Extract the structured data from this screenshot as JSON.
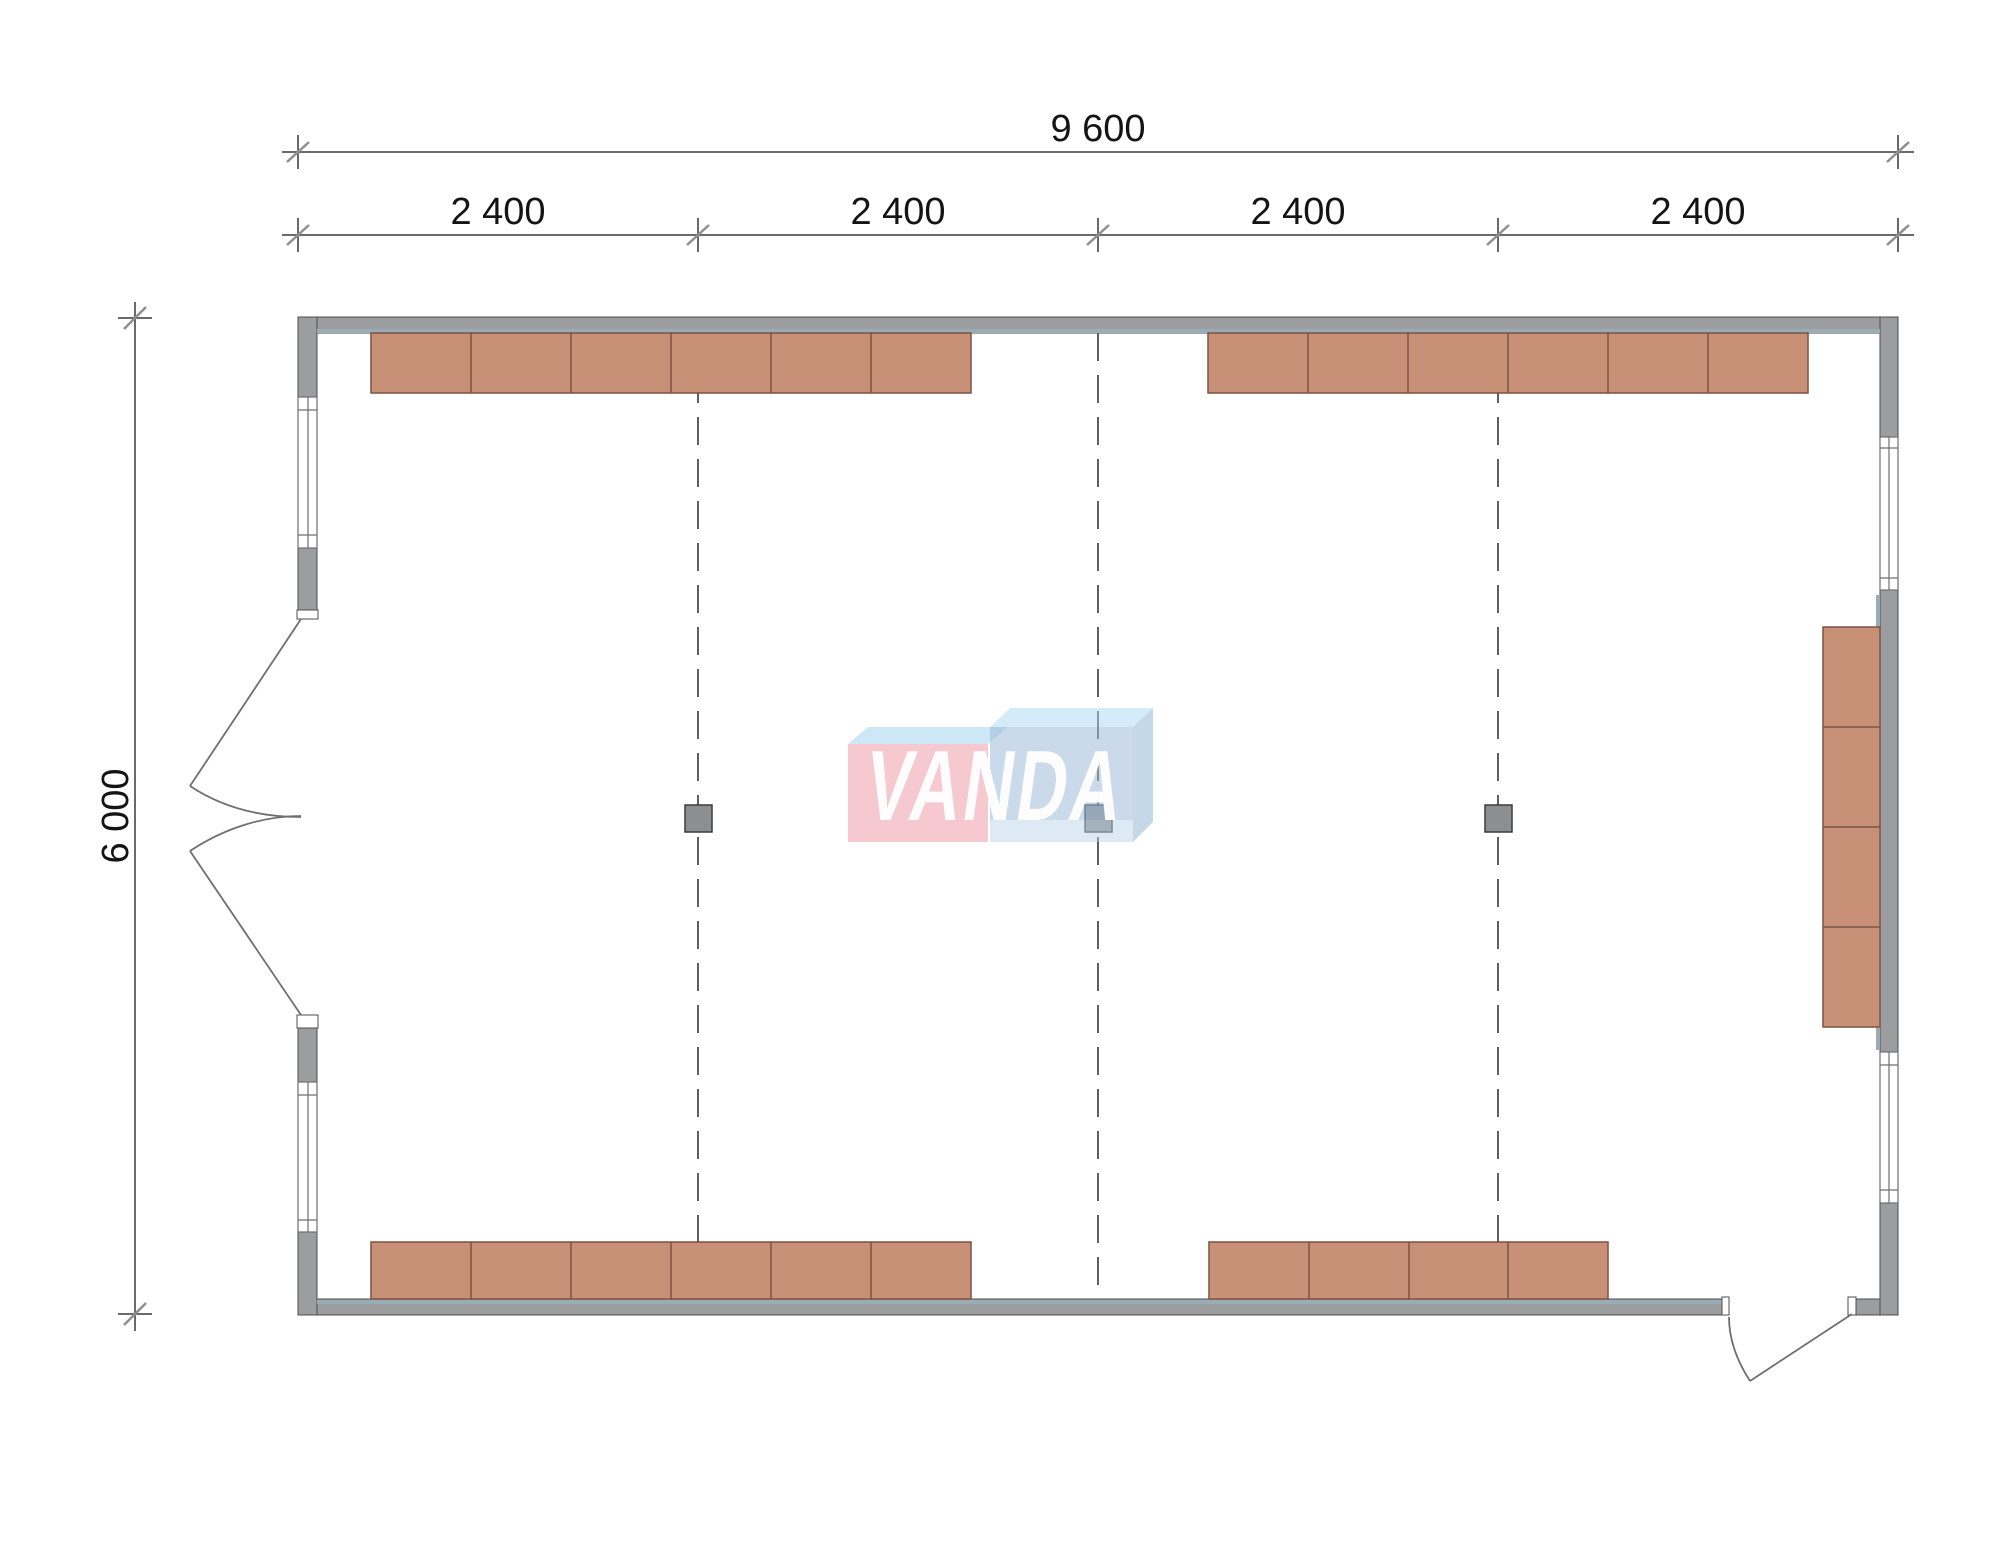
{
  "drawing": {
    "dimensions": {
      "total_width": "9 600",
      "segments": [
        "2 400",
        "2 400",
        "2 400",
        "2 400"
      ],
      "height": "6 000"
    },
    "watermark": "VANDA"
  },
  "colors": {
    "wall": "#9b9d9e",
    "wall_outline": "#4d4d4d",
    "lining": "#9aacb6",
    "furniture": "#c79077",
    "furniture_outline": "#7a5340",
    "dim_line": "#6a6a6a",
    "dim_slash": "#8f8f8f",
    "dim_text": "#141414",
    "win_line": "#6f6f6f",
    "door_line": "#6f6f6f",
    "grid_dash": "#5f5f5f",
    "column": "#8c8e90",
    "column_outline": "#3c3c3c",
    "logo_pink_front": "rgba(240,166,178,0.62)",
    "logo_pink_top": "rgba(164,212,240,0.55)",
    "logo_blue_top": "rgba(170,216,243,0.50)",
    "logo_blue_front": "rgba(158,188,217,0.55)",
    "logo_blue_bottom": "rgba(188,214,236,0.50)",
    "logo_blue_side": "rgba(140,178,210,0.50)",
    "logo_text": "rgba(255,255,255,0.95)"
  }
}
